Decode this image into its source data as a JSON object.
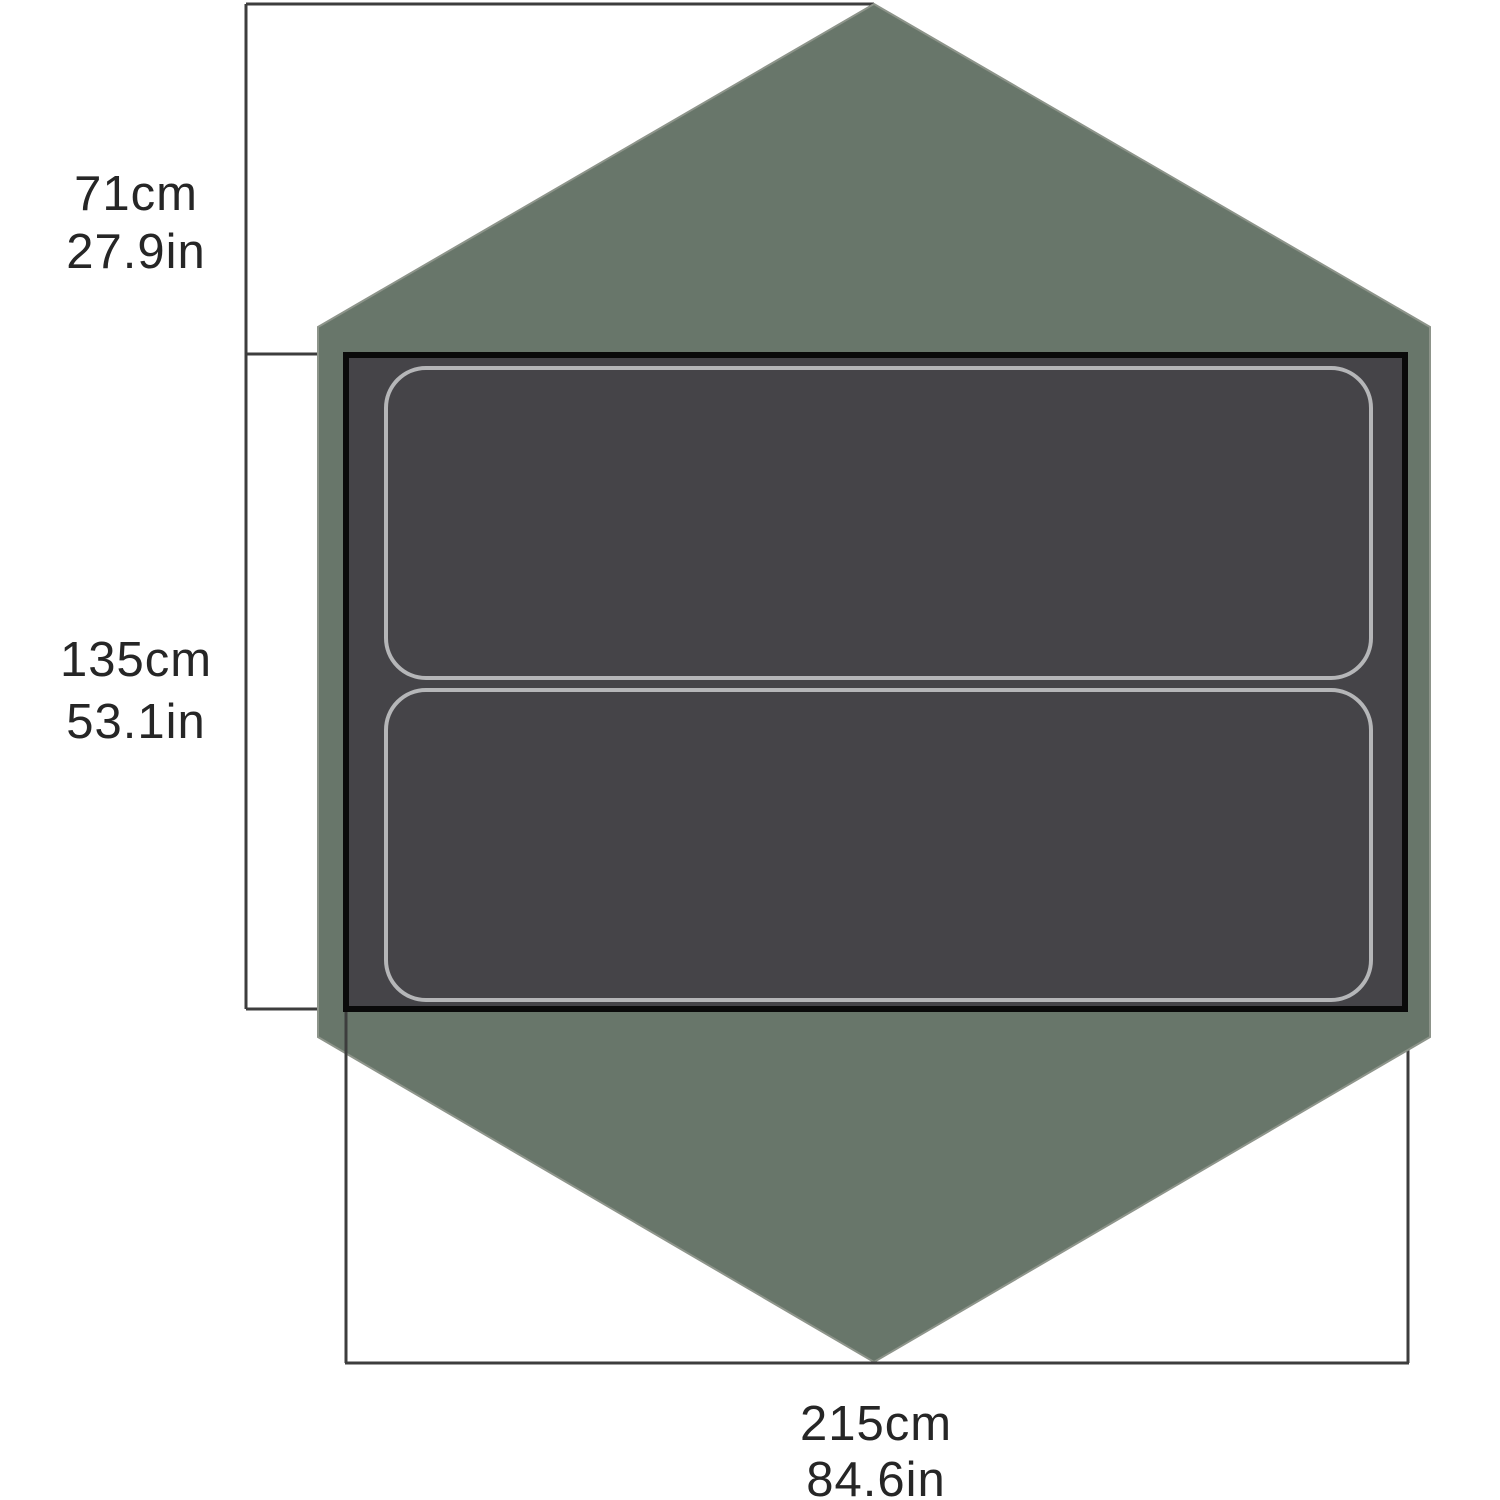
{
  "diagram": {
    "dimensions": {
      "vestibule_depth": {
        "metric": "71cm",
        "imperial": "27.9in"
      },
      "floor_width": {
        "metric": "135cm",
        "imperial": "53.1in"
      },
      "floor_length": {
        "metric": "215cm",
        "imperial": "84.6in"
      }
    },
    "colors": {
      "background": "#ffffff",
      "footprint_fill": "#68766a",
      "footprint_edge": "#8d948a",
      "floor_fill": "#454448",
      "floor_border": "#0a0a0a",
      "pad_outline": "#b5b6b8",
      "dimension_line": "#3d3d3d",
      "label_text": "#262626"
    }
  }
}
